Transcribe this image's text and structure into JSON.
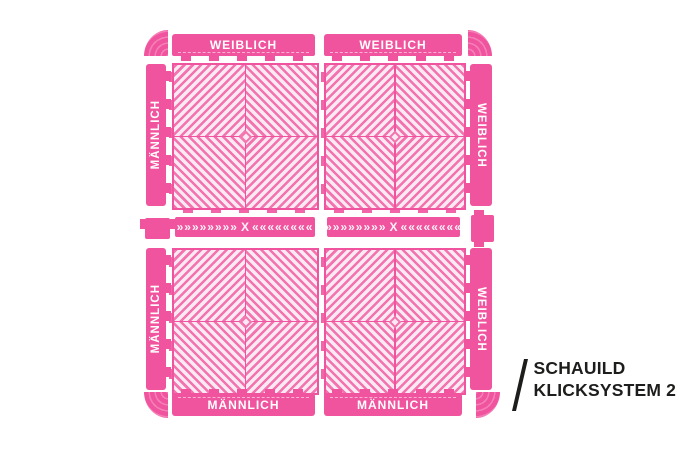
{
  "colors": {
    "pink": "#f0549e",
    "pink_rib": "#f273ae",
    "pink_pale": "#fce9f3",
    "label_text": "#ffffff",
    "logo_text": "#1d1d1b",
    "background": "#ffffff"
  },
  "kit": {
    "edge_top": [
      {
        "label": "WEIBLICH"
      },
      {
        "label": "WEIBLICH"
      }
    ],
    "edge_bottom": [
      {
        "label": "MÄNNLICH"
      },
      {
        "label": "MÄNNLICH"
      }
    ],
    "edge_left": [
      {
        "label": "MÄNNLICH"
      },
      {
        "label": "MÄNNLICH"
      }
    ],
    "edge_right": [
      {
        "label": "WEIBLICH"
      },
      {
        "label": "WEIBLICH"
      }
    ],
    "transition": {
      "left_chevrons": "»»»»»»»»",
      "center": "X",
      "right_chevrons": "««««««««"
    }
  },
  "brand": {
    "line1": "SCHAUILD",
    "line2": "KLICKSYSTEM 2"
  }
}
